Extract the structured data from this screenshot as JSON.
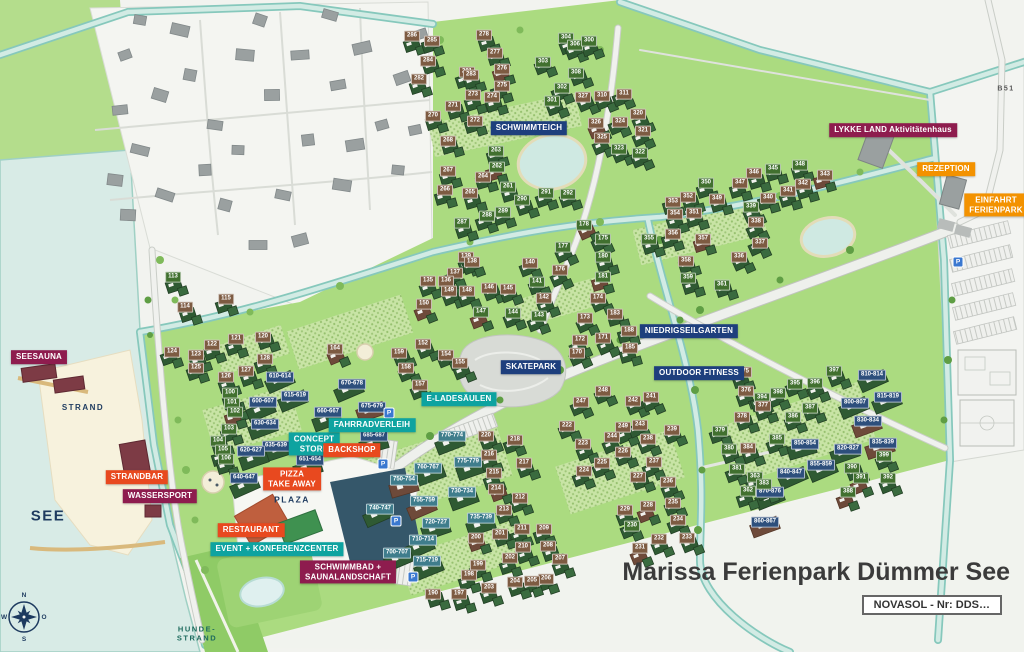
{
  "title": "Marissa Ferienpark Dümmer See",
  "subtitle_box": "NOVASOL - Nr: DDS…",
  "road_label": "B51",
  "parking_symbol": "P",
  "parking_positions": [
    [
      389,
      413
    ],
    [
      383,
      464
    ],
    [
      396,
      521
    ],
    [
      413,
      577
    ],
    [
      958,
      262
    ]
  ],
  "compass": {
    "north": "N",
    "east": "O",
    "south": "S",
    "west": "W"
  },
  "colors": {
    "magenta": "#8e1c4e",
    "red": "#e8491f",
    "orange": "#f39200",
    "teal": "#0ea3a0",
    "navy": "#1e3f7d",
    "tag_brown": "#7d5b42",
    "tag_green": "#41702f",
    "tag_navy": "#2d4f7c",
    "tag_teal": "#3f7d8c",
    "text_navy": "#1d3a5f",
    "text_teal_dark": "#1d6a5d",
    "park_green": "#abdb80",
    "water": "#d8ebe6"
  },
  "facility_labels": [
    {
      "text": "SEESAUNA",
      "x": 39,
      "y": 357,
      "color": "magenta"
    },
    {
      "text": "STRANDBAR",
      "x": 137,
      "y": 477,
      "color": "red"
    },
    {
      "text": "WASSERSPORT",
      "x": 160,
      "y": 496,
      "color": "magenta"
    },
    {
      "text": "RESTAURANT",
      "x": 251,
      "y": 530,
      "color": "red"
    },
    {
      "text": "EVENT + KONFERENZCENTER",
      "x": 277,
      "y": 549,
      "color": "teal"
    },
    {
      "text": "SCHWIMMBAD +\nSAUNALANDSCHAFT",
      "x": 348,
      "y": 572,
      "color": "magenta"
    },
    {
      "text": "PIZZA\nTAKE AWAY",
      "x": 292,
      "y": 479,
      "color": "red"
    },
    {
      "text": "CONCEPT\nSTORE",
      "x": 314,
      "y": 444,
      "color": "teal"
    },
    {
      "text": "BACKSHOP",
      "x": 352,
      "y": 450,
      "color": "red"
    },
    {
      "text": "FAHRRADVERLEIH",
      "x": 372,
      "y": 425,
      "color": "teal"
    },
    {
      "text": "E-LADESÄULEN",
      "x": 459,
      "y": 399,
      "color": "teal"
    },
    {
      "text": "SKATEPARK",
      "x": 531,
      "y": 367,
      "color": "navy"
    },
    {
      "text": "SCHWIMMTEICH",
      "x": 529,
      "y": 128,
      "color": "navy"
    },
    {
      "text": "NIEDRIGSEILGARTEN",
      "x": 689,
      "y": 331,
      "color": "navy"
    },
    {
      "text": "OUTDOOR FITNESS",
      "x": 699,
      "y": 373,
      "color": "navy"
    },
    {
      "text": "LYKKE LAND Aktivitätenhaus",
      "x": 893,
      "y": 130,
      "color": "magenta"
    },
    {
      "text": "REZEPTION",
      "x": 946,
      "y": 169,
      "color": "orange"
    },
    {
      "text": "EINFAHRT\nFERIENPARK",
      "x": 996,
      "y": 205,
      "color": "orange"
    }
  ],
  "area_labels": [
    {
      "text": "STRAND",
      "x": 83,
      "y": 408,
      "color": "text_navy",
      "size": 8
    },
    {
      "text": "SEE",
      "x": 48,
      "y": 517,
      "color": "text_navy",
      "size": 15
    },
    {
      "text": "PLAZA",
      "x": 292,
      "y": 500,
      "color": "text_navy",
      "size": 8.5
    },
    {
      "text": "HUNDE-\nSTRAND",
      "x": 197,
      "y": 634,
      "color": "text_teal_dark",
      "size": 7.5
    },
    {
      "text": "B51",
      "x": 1006,
      "y": 90,
      "color": "#555",
      "size": 7
    }
  ],
  "units": [
    [
      "278",
      484,
      35,
      "b"
    ],
    [
      "281",
      467,
      72,
      "b"
    ],
    [
      "277",
      495,
      53,
      "b"
    ],
    [
      "276",
      502,
      69,
      "b"
    ],
    [
      "275",
      502,
      86,
      "b"
    ],
    [
      "274",
      492,
      97,
      "b"
    ],
    [
      "273",
      473,
      95,
      "b"
    ],
    [
      "272",
      475,
      121,
      "b"
    ],
    [
      "271",
      453,
      106,
      "b"
    ],
    [
      "270",
      433,
      116,
      "b"
    ],
    [
      "286",
      412,
      36,
      "b"
    ],
    [
      "285",
      432,
      41,
      "b"
    ],
    [
      "284",
      428,
      61,
      "b"
    ],
    [
      "283",
      471,
      75,
      "b"
    ],
    [
      "282",
      419,
      79,
      "b"
    ],
    [
      "304",
      566,
      38,
      "g"
    ],
    [
      "306",
      575,
      45,
      "g"
    ],
    [
      "300",
      589,
      41,
      "g"
    ],
    [
      "303",
      543,
      62,
      "g"
    ],
    [
      "302",
      562,
      88,
      "g"
    ],
    [
      "301",
      552,
      101,
      "g"
    ],
    [
      "308",
      576,
      73,
      "g"
    ],
    [
      "327",
      583,
      97,
      "b"
    ],
    [
      "310",
      602,
      96,
      "b"
    ],
    [
      "311",
      624,
      94,
      "b"
    ],
    [
      "326",
      596,
      123,
      "b"
    ],
    [
      "324",
      620,
      122,
      "b"
    ],
    [
      "320",
      638,
      114,
      "b"
    ],
    [
      "321",
      643,
      131,
      "b"
    ],
    [
      "325",
      602,
      138,
      "b"
    ],
    [
      "323",
      619,
      149,
      "g"
    ],
    [
      "322",
      640,
      153,
      "g"
    ],
    [
      "268",
      448,
      141,
      "b"
    ],
    [
      "263",
      496,
      151,
      "g"
    ],
    [
      "267",
      448,
      171,
      "b"
    ],
    [
      "264",
      483,
      177,
      "b"
    ],
    [
      "262",
      497,
      167,
      "g"
    ],
    [
      "266",
      445,
      190,
      "b"
    ],
    [
      "265",
      470,
      193,
      "b"
    ],
    [
      "261",
      508,
      187,
      "g"
    ],
    [
      "290",
      522,
      200,
      "g"
    ],
    [
      "291",
      546,
      193,
      "g"
    ],
    [
      "292",
      568,
      194,
      "g"
    ],
    [
      "287",
      462,
      223,
      "g"
    ],
    [
      "288",
      487,
      216,
      "g"
    ],
    [
      "289",
      503,
      212,
      "g"
    ],
    [
      "113",
      173,
      277,
      "g"
    ],
    [
      "114",
      185,
      307,
      "b"
    ],
    [
      "115",
      226,
      299,
      "b"
    ],
    [
      "121",
      236,
      339,
      "b"
    ],
    [
      "122",
      212,
      345,
      "b"
    ],
    [
      "120",
      263,
      337,
      "b"
    ],
    [
      "124",
      172,
      352,
      "b"
    ],
    [
      "123",
      196,
      355,
      "b"
    ],
    [
      "125",
      196,
      368,
      "b"
    ],
    [
      "126",
      226,
      377,
      "b"
    ],
    [
      "127",
      246,
      371,
      "b"
    ],
    [
      "128",
      265,
      359,
      "b"
    ],
    [
      "100",
      230,
      393,
      "g"
    ],
    [
      "101",
      232,
      403,
      "g"
    ],
    [
      "102",
      235,
      412,
      "g"
    ],
    [
      "103",
      229,
      429,
      "g"
    ],
    [
      "104",
      218,
      441,
      "g"
    ],
    [
      "105",
      223,
      450,
      "g"
    ],
    [
      "106",
      226,
      459,
      "g"
    ],
    [
      "600-607",
      263,
      402,
      "n"
    ],
    [
      "615-619",
      295,
      396,
      "n"
    ],
    [
      "610-614",
      280,
      377,
      "n"
    ],
    [
      "630-634",
      265,
      424,
      "n"
    ],
    [
      "635-639",
      276,
      446,
      "n"
    ],
    [
      "620-627",
      251,
      451,
      "n"
    ],
    [
      "640-647",
      244,
      478,
      "n"
    ],
    [
      "651-654",
      310,
      460,
      "n"
    ],
    [
      "660-667",
      328,
      412,
      "n"
    ],
    [
      "670-678",
      352,
      384,
      "n"
    ],
    [
      "675-679",
      372,
      407,
      "n"
    ],
    [
      "685-687",
      374,
      436,
      "n"
    ],
    [
      "164",
      335,
      349,
      "b"
    ],
    [
      "152",
      423,
      344,
      "b"
    ],
    [
      "159",
      399,
      353,
      "b"
    ],
    [
      "154",
      446,
      355,
      "b"
    ],
    [
      "155",
      460,
      363,
      "b"
    ],
    [
      "158",
      406,
      368,
      "b"
    ],
    [
      "157",
      420,
      385,
      "b"
    ],
    [
      "139",
      466,
      257,
      "b"
    ],
    [
      "138",
      472,
      262,
      "b"
    ],
    [
      "137",
      455,
      273,
      "b"
    ],
    [
      "135",
      428,
      281,
      "b"
    ],
    [
      "136",
      446,
      281,
      "b"
    ],
    [
      "140",
      530,
      263,
      "b"
    ],
    [
      "141",
      537,
      282,
      "g"
    ],
    [
      "142",
      544,
      298,
      "b"
    ],
    [
      "143",
      539,
      316,
      "g"
    ],
    [
      "149",
      449,
      291,
      "b"
    ],
    [
      "148",
      467,
      291,
      "b"
    ],
    [
      "146",
      489,
      288,
      "b"
    ],
    [
      "145",
      508,
      289,
      "b"
    ],
    [
      "150",
      424,
      304,
      "b"
    ],
    [
      "147",
      481,
      312,
      "g"
    ],
    [
      "144",
      513,
      313,
      "g"
    ],
    [
      "178",
      584,
      225,
      "g"
    ],
    [
      "177",
      563,
      247,
      "g"
    ],
    [
      "175",
      603,
      239,
      "g"
    ],
    [
      "181",
      603,
      277,
      "g"
    ],
    [
      "176",
      560,
      270,
      "b"
    ],
    [
      "174",
      598,
      298,
      "b"
    ],
    [
      "173",
      585,
      318,
      "b"
    ],
    [
      "172",
      580,
      340,
      "b"
    ],
    [
      "171",
      603,
      338,
      "b"
    ],
    [
      "170",
      577,
      353,
      "b"
    ],
    [
      "183",
      615,
      314,
      "b"
    ],
    [
      "188",
      629,
      331,
      "b"
    ],
    [
      "185",
      630,
      348,
      "b"
    ],
    [
      "180",
      603,
      257,
      "g"
    ],
    [
      "348",
      800,
      165,
      "g"
    ],
    [
      "346",
      754,
      173,
      "b"
    ],
    [
      "345",
      773,
      169,
      "g"
    ],
    [
      "343",
      825,
      175,
      "b"
    ],
    [
      "342",
      803,
      184,
      "b"
    ],
    [
      "341",
      788,
      191,
      "b"
    ],
    [
      "340",
      768,
      198,
      "b"
    ],
    [
      "347",
      740,
      183,
      "b"
    ],
    [
      "350",
      706,
      183,
      "g"
    ],
    [
      "352",
      688,
      197,
      "b"
    ],
    [
      "353",
      673,
      202,
      "b"
    ],
    [
      "349",
      717,
      199,
      "b"
    ],
    [
      "351",
      694,
      213,
      "b"
    ],
    [
      "354",
      675,
      214,
      "b"
    ],
    [
      "355",
      649,
      239,
      "g"
    ],
    [
      "356",
      673,
      234,
      "b"
    ],
    [
      "357",
      703,
      239,
      "b"
    ],
    [
      "339",
      751,
      207,
      "g"
    ],
    [
      "338",
      756,
      222,
      "b"
    ],
    [
      "337",
      760,
      243,
      "b"
    ],
    [
      "336",
      739,
      257,
      "b"
    ],
    [
      "358",
      686,
      261,
      "b"
    ],
    [
      "359",
      688,
      278,
      "g"
    ],
    [
      "361",
      722,
      285,
      "g"
    ],
    [
      "375",
      744,
      372,
      "b"
    ],
    [
      "397",
      834,
      371,
      "g"
    ],
    [
      "810-814",
      872,
      375,
      "n"
    ],
    [
      "396",
      815,
      383,
      "g"
    ],
    [
      "395",
      795,
      384,
      "g"
    ],
    [
      "376",
      746,
      391,
      "b"
    ],
    [
      "398",
      778,
      393,
      "g"
    ],
    [
      "394",
      762,
      398,
      "g"
    ],
    [
      "815-819",
      888,
      397,
      "n"
    ],
    [
      "800-807",
      855,
      403,
      "n"
    ],
    [
      "377",
      763,
      406,
      "b"
    ],
    [
      "387",
      810,
      408,
      "g"
    ],
    [
      "386",
      793,
      417,
      "g"
    ],
    [
      "378",
      742,
      417,
      "b"
    ],
    [
      "830-834",
      868,
      421,
      "n"
    ],
    [
      "385",
      777,
      439,
      "g"
    ],
    [
      "850-854",
      805,
      444,
      "n"
    ],
    [
      "835-839",
      883,
      443,
      "n"
    ],
    [
      "384",
      748,
      448,
      "b"
    ],
    [
      "820-827",
      848,
      449,
      "n"
    ],
    [
      "399",
      884,
      456,
      "g"
    ],
    [
      "855-859",
      821,
      465,
      "n"
    ],
    [
      "390",
      852,
      468,
      "g"
    ],
    [
      "840-847",
      791,
      473,
      "n"
    ],
    [
      "363",
      755,
      477,
      "g"
    ],
    [
      "391",
      861,
      478,
      "g"
    ],
    [
      "392",
      888,
      478,
      "g"
    ],
    [
      "870-876",
      770,
      492,
      "n"
    ],
    [
      "362",
      748,
      491,
      "g"
    ],
    [
      "388",
      848,
      492,
      "g"
    ],
    [
      "860-867",
      765,
      522,
      "n"
    ],
    [
      "379",
      720,
      431,
      "g"
    ],
    [
      "380",
      729,
      449,
      "g"
    ],
    [
      "381",
      737,
      469,
      "g"
    ],
    [
      "383",
      764,
      484,
      "g"
    ],
    [
      "770-774",
      452,
      436,
      "t"
    ],
    [
      "220",
      486,
      436,
      "b"
    ],
    [
      "218",
      515,
      440,
      "b"
    ],
    [
      "775-779",
      468,
      462,
      "t"
    ],
    [
      "760-767",
      428,
      468,
      "t"
    ],
    [
      "216",
      489,
      455,
      "b"
    ],
    [
      "217",
      524,
      463,
      "b"
    ],
    [
      "215",
      494,
      473,
      "b"
    ],
    [
      "750-754",
      404,
      480,
      "t"
    ],
    [
      "214",
      496,
      489,
      "b"
    ],
    [
      "730-734",
      462,
      492,
      "t"
    ],
    [
      "755-759",
      424,
      501,
      "t"
    ],
    [
      "213",
      504,
      510,
      "b"
    ],
    [
      "740-747",
      380,
      509,
      "t"
    ],
    [
      "735-739",
      481,
      518,
      "t"
    ],
    [
      "720-727",
      436,
      523,
      "t"
    ],
    [
      "212",
      520,
      498,
      "b"
    ],
    [
      "211",
      522,
      529,
      "b"
    ],
    [
      "209",
      544,
      529,
      "b"
    ],
    [
      "201",
      500,
      534,
      "b"
    ],
    [
      "200",
      476,
      538,
      "b"
    ],
    [
      "710-714",
      423,
      540,
      "t"
    ],
    [
      "210",
      523,
      547,
      "b"
    ],
    [
      "208",
      548,
      546,
      "b"
    ],
    [
      "700-707",
      397,
      553,
      "t"
    ],
    [
      "202",
      510,
      558,
      "b"
    ],
    [
      "715-719",
      427,
      561,
      "t"
    ],
    [
      "207",
      560,
      559,
      "b"
    ],
    [
      "199",
      478,
      565,
      "b"
    ],
    [
      "206",
      546,
      579,
      "b"
    ],
    [
      "198",
      469,
      575,
      "b"
    ],
    [
      "205",
      532,
      581,
      "b"
    ],
    [
      "204",
      515,
      582,
      "b"
    ],
    [
      "203",
      489,
      588,
      "b"
    ],
    [
      "197",
      459,
      594,
      "b"
    ],
    [
      "190",
      433,
      594,
      "b"
    ],
    [
      "222",
      567,
      426,
      "b"
    ],
    [
      "223",
      583,
      444,
      "b"
    ],
    [
      "249",
      623,
      427,
      "b"
    ],
    [
      "244",
      612,
      437,
      "b"
    ],
    [
      "243",
      640,
      425,
      "b"
    ],
    [
      "239",
      672,
      430,
      "b"
    ],
    [
      "238",
      648,
      439,
      "b"
    ],
    [
      "226",
      623,
      452,
      "b"
    ],
    [
      "225",
      602,
      463,
      "b"
    ],
    [
      "237",
      654,
      462,
      "b"
    ],
    [
      "224",
      584,
      471,
      "b"
    ],
    [
      "227",
      638,
      477,
      "b"
    ],
    [
      "236",
      668,
      482,
      "b"
    ],
    [
      "229",
      625,
      510,
      "b"
    ],
    [
      "228",
      648,
      506,
      "b"
    ],
    [
      "235",
      673,
      503,
      "b"
    ],
    [
      "230",
      632,
      526,
      "g"
    ],
    [
      "234",
      678,
      520,
      "b"
    ],
    [
      "232",
      659,
      539,
      "b"
    ],
    [
      "233",
      687,
      538,
      "b"
    ],
    [
      "231",
      640,
      548,
      "b"
    ],
    [
      "248",
      603,
      391,
      "b"
    ],
    [
      "247",
      581,
      402,
      "b"
    ],
    [
      "242",
      633,
      401,
      "b"
    ],
    [
      "241",
      651,
      397,
      "b"
    ]
  ]
}
